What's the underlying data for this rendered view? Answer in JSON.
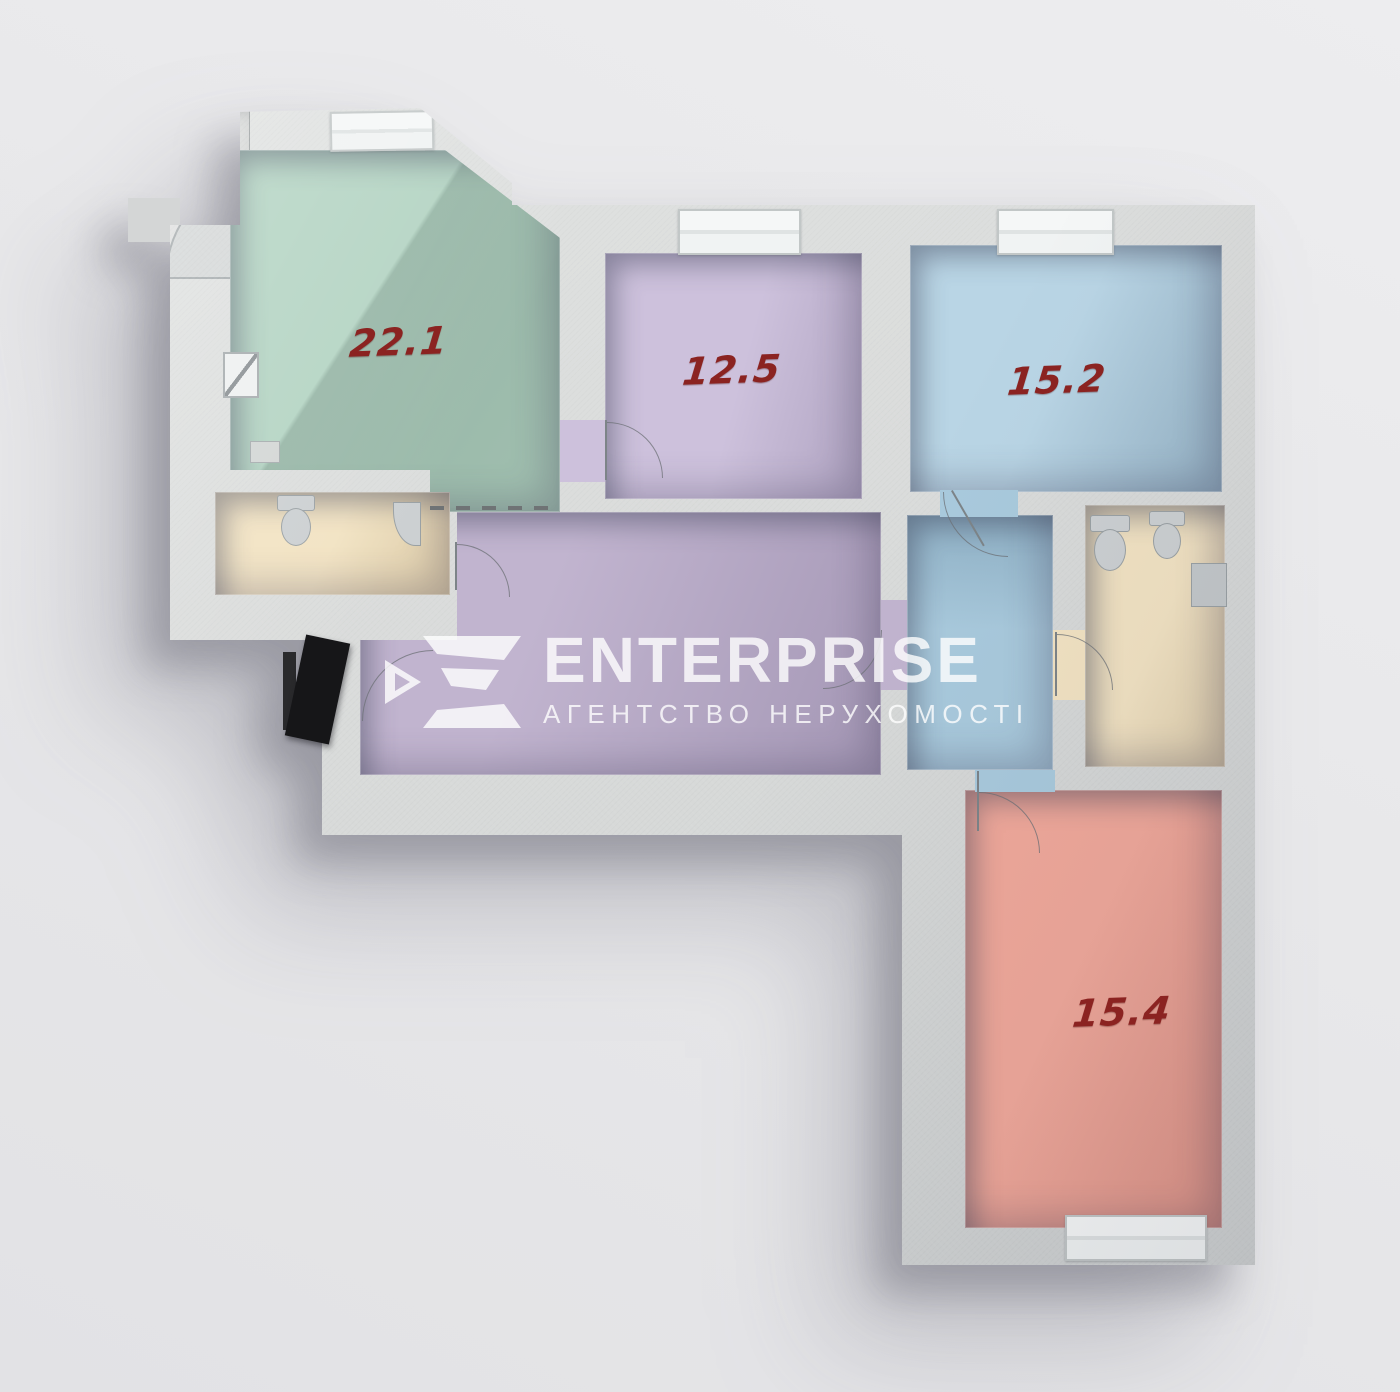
{
  "watermark": {
    "brand": "ENTERPRISE",
    "tagline": "АГЕНТСТВО НЕРУХОМОСТІ",
    "logo_icon": "enterprise-e-mark-icon",
    "text_color": "#ffffff"
  },
  "floor_plan": {
    "type": "3d-apartment-floor-plan",
    "label_color": "#8b2321",
    "wall_color": "#d9dbda",
    "background_color": "#e9e9eb",
    "rooms": [
      {
        "name": "living-room",
        "area_label": "22.1",
        "floor_color": "#b4d4c3"
      },
      {
        "name": "bedroom-top-middle",
        "area_label": "12.5",
        "floor_color": "#cdc1dc"
      },
      {
        "name": "bedroom-top-right",
        "area_label": "15.2",
        "floor_color": "#b9d5e5"
      },
      {
        "name": "bedroom-bottom-right",
        "area_label": "15.4",
        "floor_color": "#f1a99b"
      },
      {
        "name": "hallway",
        "floor_color": "#c1b4cf"
      },
      {
        "name": "corridor",
        "floor_color": "#a9cadd"
      },
      {
        "name": "bathroom-small",
        "floor_color": "#f2e3c3"
      },
      {
        "name": "bathroom-large",
        "floor_color": "#f2e3c3"
      }
    ],
    "fixtures": [
      "toilet",
      "corner-sink",
      "toilet",
      "bidet",
      "boiler-cabinet",
      "corner-shower",
      "entrance-door",
      "electrical-panel"
    ]
  }
}
